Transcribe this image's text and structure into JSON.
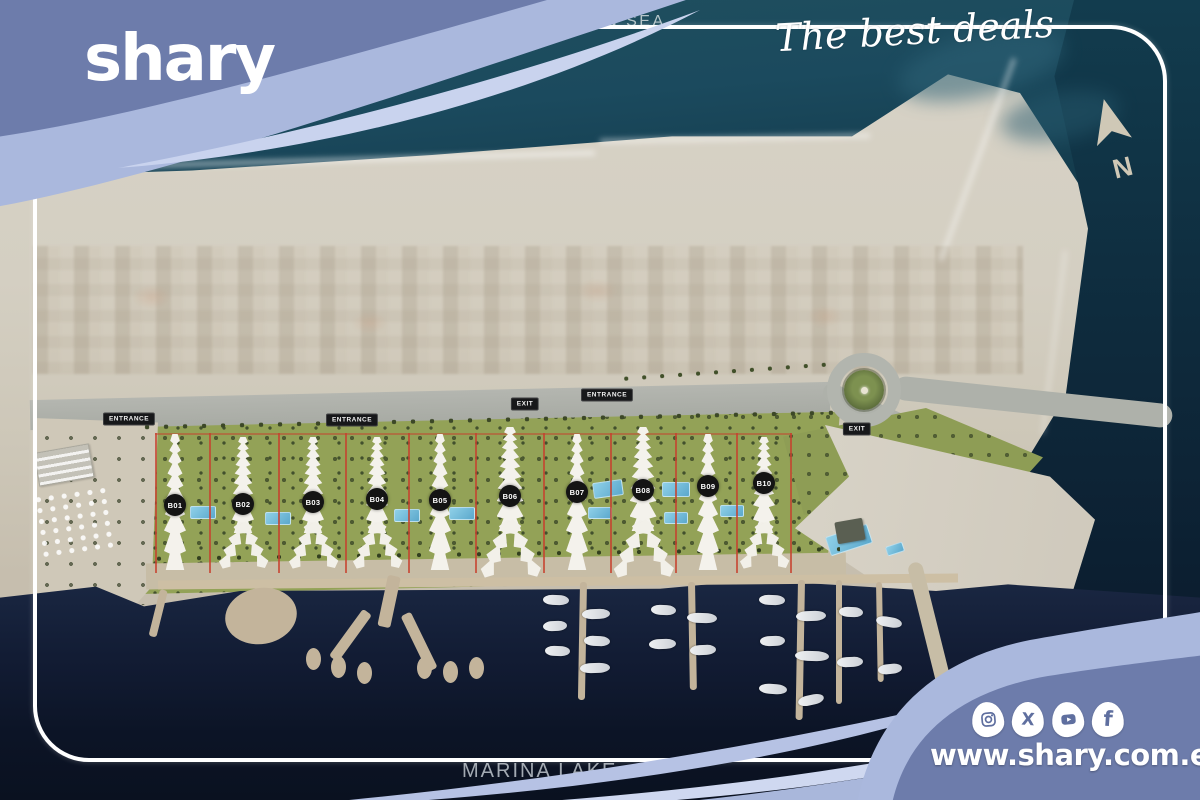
{
  "branding": {
    "logo_text": "shary",
    "tagline": "The best deals",
    "website": "www.shary.com.eg",
    "social": [
      {
        "name": "instagram-icon",
        "label": "Instagram"
      },
      {
        "name": "x-icon",
        "label": "X"
      },
      {
        "name": "youtube-icon",
        "label": "YouTube"
      },
      {
        "name": "facebook-icon",
        "label": "Facebook"
      }
    ]
  },
  "map": {
    "sea_label": "MEDITERRANEAN SEA",
    "lake_label": "MARINA LAKE",
    "north_indicator": "N",
    "buildings": [
      {
        "label": "B01",
        "x": 175,
        "y": 505,
        "variant": "i"
      },
      {
        "label": "B02",
        "x": 243,
        "y": 504,
        "variant": "y"
      },
      {
        "label": "B03",
        "x": 313,
        "y": 502,
        "variant": "y"
      },
      {
        "label": "B04",
        "x": 377,
        "y": 499,
        "variant": "y"
      },
      {
        "label": "B05",
        "x": 440,
        "y": 500,
        "variant": "i"
      },
      {
        "label": "B06",
        "x": 510,
        "y": 496,
        "variant": "Y"
      },
      {
        "label": "B07",
        "x": 577,
        "y": 492,
        "variant": "i"
      },
      {
        "label": "B08",
        "x": 643,
        "y": 490,
        "variant": "Y"
      },
      {
        "label": "B09",
        "x": 708,
        "y": 486,
        "variant": "i"
      },
      {
        "label": "B10",
        "x": 764,
        "y": 483,
        "variant": "y"
      }
    ],
    "road_labels": [
      {
        "text": "ENTRANCE",
        "x": 129,
        "y": 419
      },
      {
        "text": "ENTRANCE",
        "x": 352,
        "y": 420
      },
      {
        "text": "EXIT",
        "x": 525,
        "y": 404
      },
      {
        "text": "ENTRANCE",
        "x": 607,
        "y": 395
      },
      {
        "text": "EXIT",
        "x": 857,
        "y": 429
      }
    ]
  },
  "colors": {
    "wave_slate": "#6d7cab",
    "wave_light": "#aab8dd",
    "sea_dark": "#123c4e",
    "marina_dark": "#0c1426",
    "beach": "#d3cec1",
    "greenery": "#93a257",
    "boundary_red": "#c6402e",
    "badge_black": "#141414"
  }
}
